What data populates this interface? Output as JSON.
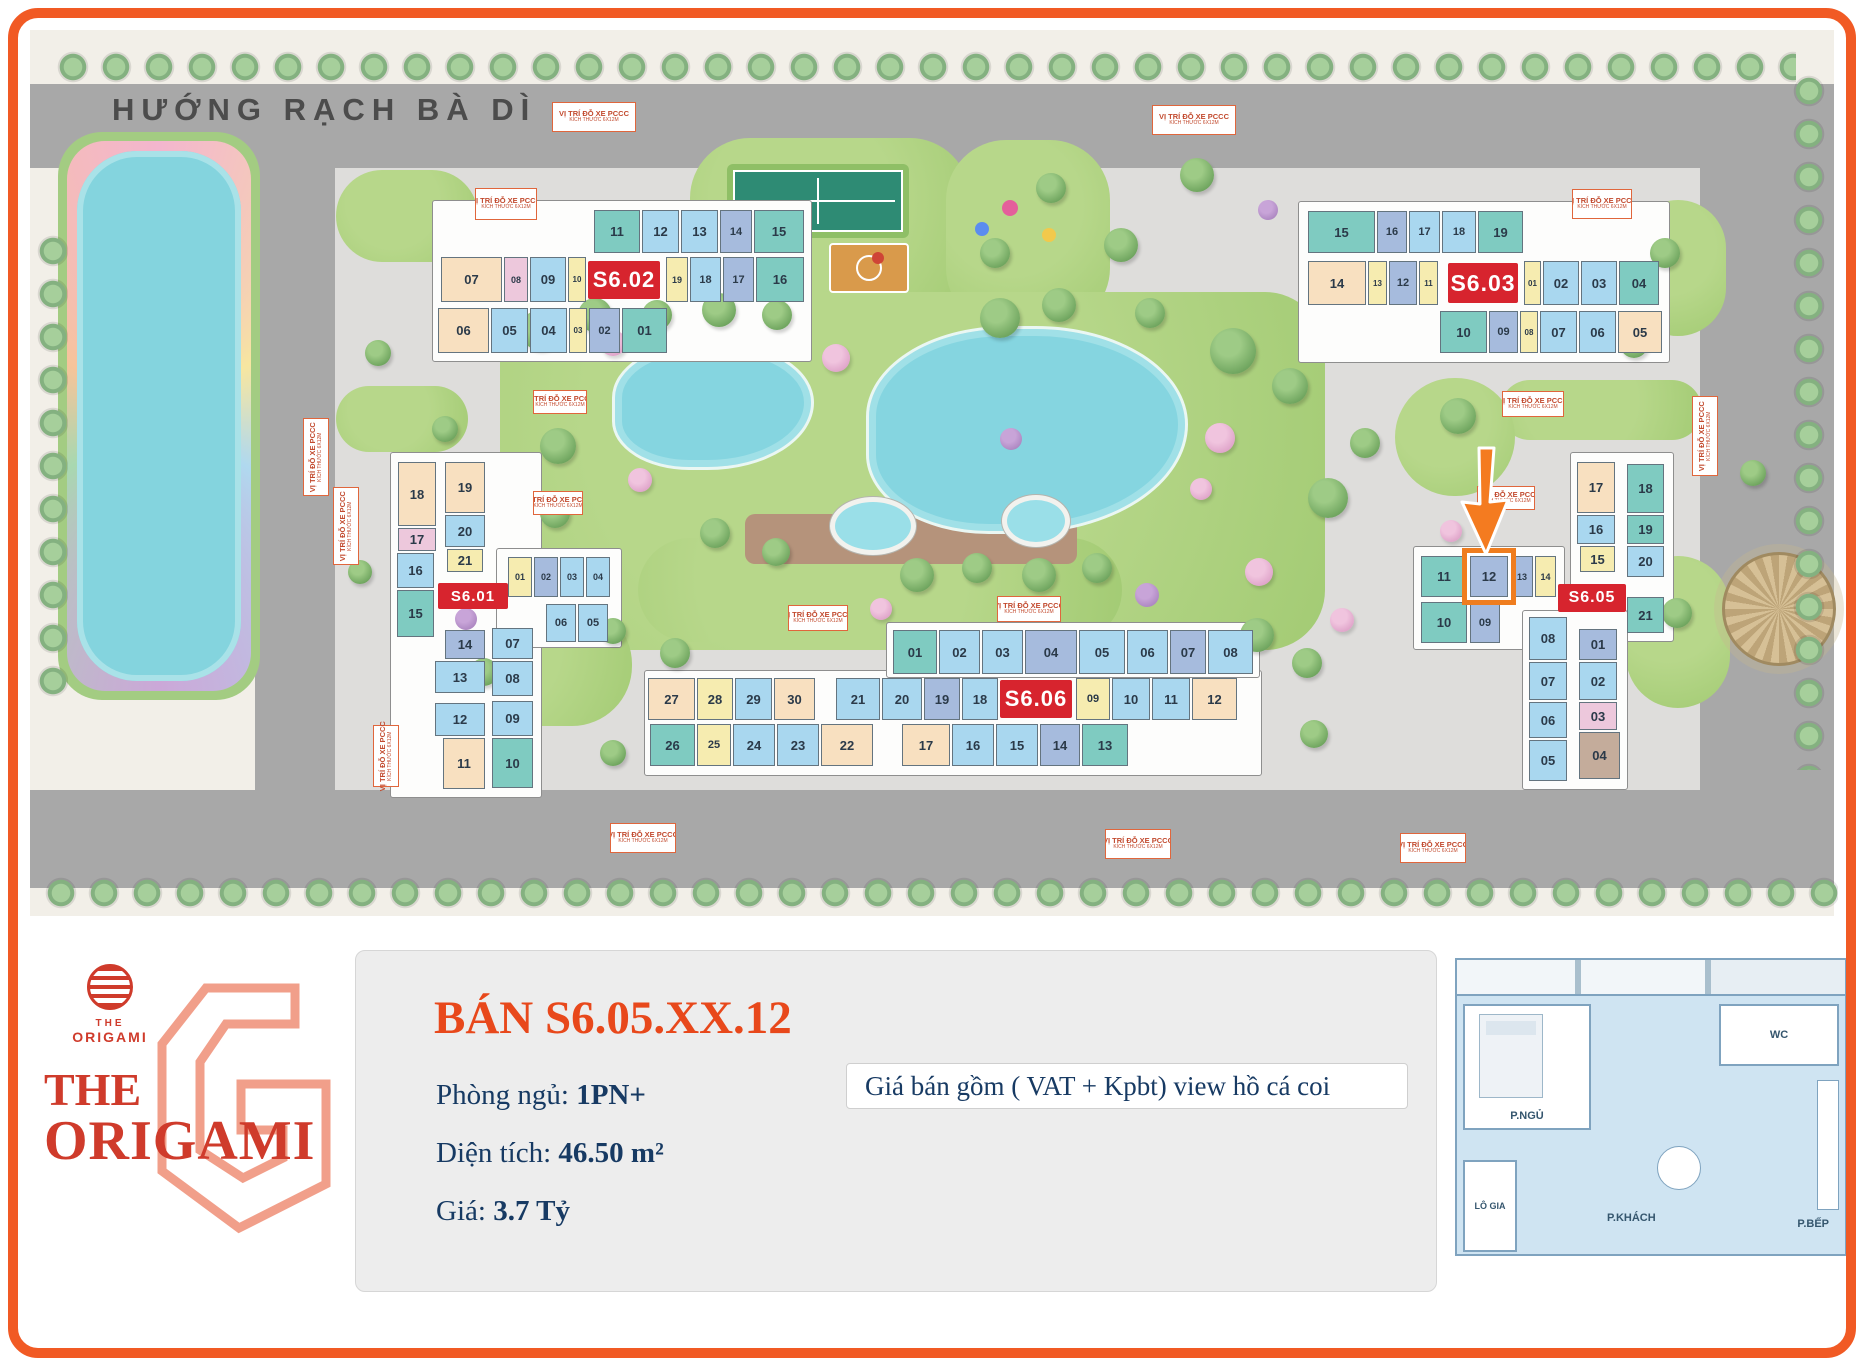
{
  "frame_color": "#F15A24",
  "map": {
    "road_label": "HƯỚNG RẠCH BÀ DÌ",
    "pccc_marker": {
      "line1": "VỊ TRÍ ĐỖ XE PCCC",
      "line2": "KÍCH THƯỚC 6X12M"
    },
    "label_color": "#D7242E",
    "highlight": {
      "building": "S6.05",
      "unit": "12",
      "color": "#EF7D1F"
    },
    "unit_colors": {
      "teal": "#7FCBC1",
      "blue": "#A9D7EF",
      "peri": "#A6BBDD",
      "yellow": "#F6ECB0",
      "cream": "#F8E0C0",
      "pink": "#EDC8DC",
      "tan": "#C4AC9B"
    },
    "marker_positions": [
      [
        475,
        188,
        62,
        32,
        0
      ],
      [
        552,
        102,
        84,
        30,
        0
      ],
      [
        1152,
        105,
        84,
        30,
        0
      ],
      [
        1572,
        189,
        60,
        30,
        0
      ],
      [
        533,
        390,
        54,
        24,
        0
      ],
      [
        533,
        491,
        50,
        24,
        0
      ],
      [
        1502,
        391,
        62,
        26,
        0
      ],
      [
        1477,
        486,
        58,
        24,
        0
      ],
      [
        788,
        605,
        60,
        26,
        0
      ],
      [
        997,
        596,
        64,
        26,
        0
      ],
      [
        610,
        823,
        66,
        30,
        0
      ],
      [
        1105,
        829,
        66,
        30,
        0
      ],
      [
        1400,
        833,
        66,
        30,
        0
      ],
      [
        333,
        487,
        26,
        78,
        1
      ],
      [
        373,
        725,
        26,
        62,
        1
      ],
      [
        1692,
        396,
        26,
        80,
        1
      ],
      [
        303,
        418,
        26,
        78,
        1
      ]
    ],
    "buildings": [
      {
        "id": "S6.01",
        "label": {
          "t": "S6.01",
          "x": 438,
          "y": 583,
          "w": 70,
          "h": 26
        },
        "units": [
          [
            "18",
            398,
            462,
            38,
            64,
            "cream"
          ],
          [
            "17",
            398,
            528,
            38,
            23,
            "pink"
          ],
          [
            "16",
            397,
            553,
            37,
            35,
            "blue"
          ],
          [
            "15",
            397,
            590,
            37,
            47,
            "teal"
          ],
          [
            "19",
            445,
            462,
            40,
            51,
            "cream"
          ],
          [
            "20",
            445,
            515,
            40,
            32,
            "blue"
          ],
          [
            "21",
            447,
            549,
            36,
            23,
            "yellow"
          ],
          [
            "01",
            508,
            557,
            24,
            40,
            "yellow"
          ],
          [
            "02",
            534,
            557,
            24,
            40,
            "peri"
          ],
          [
            "03",
            560,
            557,
            24,
            40,
            "blue"
          ],
          [
            "04",
            586,
            557,
            24,
            40,
            "blue"
          ],
          [
            "06",
            546,
            604,
            30,
            38,
            "blue"
          ],
          [
            "05",
            578,
            604,
            30,
            38,
            "blue"
          ],
          [
            "14",
            445,
            630,
            40,
            29,
            "peri"
          ],
          [
            "13",
            435,
            661,
            50,
            32,
            "blue"
          ],
          [
            "12",
            435,
            703,
            50,
            33,
            "blue"
          ],
          [
            "11",
            443,
            738,
            42,
            51,
            "cream"
          ],
          [
            "07",
            492,
            628,
            41,
            31,
            "blue"
          ],
          [
            "08",
            492,
            661,
            41,
            35,
            "blue"
          ],
          [
            "09",
            492,
            701,
            41,
            35,
            "blue"
          ],
          [
            "10",
            492,
            738,
            41,
            50,
            "teal"
          ]
        ]
      },
      {
        "id": "S6.02",
        "label": {
          "t": "S6.02",
          "x": 588,
          "y": 261,
          "w": 72,
          "h": 38
        },
        "units": [
          [
            "11",
            594,
            210,
            46,
            43,
            "teal"
          ],
          [
            "12",
            642,
            210,
            37,
            43,
            "blue"
          ],
          [
            "13",
            681,
            210,
            37,
            43,
            "blue"
          ],
          [
            "14",
            720,
            210,
            32,
            43,
            "peri"
          ],
          [
            "15",
            754,
            210,
            50,
            43,
            "teal"
          ],
          [
            "07",
            441,
            257,
            61,
            45,
            "cream"
          ],
          [
            "08",
            504,
            257,
            24,
            45,
            "pink"
          ],
          [
            "09",
            530,
            257,
            36,
            45,
            "blue"
          ],
          [
            "10",
            568,
            257,
            18,
            45,
            "yellow"
          ],
          [
            "19",
            666,
            257,
            22,
            45,
            "yellow"
          ],
          [
            "18",
            690,
            257,
            31,
            45,
            "blue"
          ],
          [
            "17",
            723,
            257,
            31,
            45,
            "peri"
          ],
          [
            "16",
            756,
            257,
            48,
            45,
            "teal"
          ],
          [
            "06",
            438,
            308,
            51,
            45,
            "cream"
          ],
          [
            "05",
            491,
            308,
            37,
            45,
            "blue"
          ],
          [
            "04",
            530,
            308,
            37,
            45,
            "blue"
          ],
          [
            "03",
            569,
            308,
            18,
            45,
            "yellow"
          ],
          [
            "02",
            589,
            308,
            31,
            45,
            "peri"
          ],
          [
            "01",
            622,
            308,
            45,
            45,
            "teal"
          ]
        ]
      },
      {
        "id": "S6.03",
        "label": {
          "t": "S6.03",
          "x": 1448,
          "y": 263,
          "w": 70,
          "h": 40
        },
        "units": [
          [
            "15",
            1308,
            211,
            67,
            42,
            "teal"
          ],
          [
            "16",
            1377,
            211,
            30,
            42,
            "peri"
          ],
          [
            "17",
            1409,
            211,
            31,
            42,
            "blue"
          ],
          [
            "18",
            1442,
            211,
            34,
            42,
            "blue"
          ],
          [
            "19",
            1478,
            211,
            45,
            42,
            "teal"
          ],
          [
            "14",
            1308,
            261,
            58,
            44,
            "cream"
          ],
          [
            "13",
            1368,
            261,
            19,
            44,
            "yellow"
          ],
          [
            "12",
            1389,
            261,
            28,
            44,
            "peri"
          ],
          [
            "11",
            1419,
            261,
            19,
            44,
            "yellow"
          ],
          [
            "01",
            1524,
            261,
            17,
            44,
            "yellow"
          ],
          [
            "02",
            1543,
            261,
            36,
            44,
            "blue"
          ],
          [
            "03",
            1581,
            261,
            36,
            44,
            "blue"
          ],
          [
            "04",
            1619,
            261,
            40,
            44,
            "teal"
          ],
          [
            "10",
            1440,
            311,
            47,
            42,
            "teal"
          ],
          [
            "09",
            1489,
            311,
            29,
            42,
            "peri"
          ],
          [
            "08",
            1520,
            311,
            18,
            42,
            "yellow"
          ],
          [
            "07",
            1540,
            311,
            37,
            42,
            "blue"
          ],
          [
            "06",
            1579,
            311,
            37,
            42,
            "blue"
          ],
          [
            "05",
            1618,
            311,
            44,
            42,
            "cream"
          ]
        ]
      },
      {
        "id": "S6.05",
        "label": {
          "t": "S6.05",
          "x": 1558,
          "y": 584,
          "w": 68,
          "h": 28
        },
        "units": [
          [
            "17",
            1577,
            462,
            38,
            51,
            "cream"
          ],
          [
            "18",
            1627,
            464,
            37,
            49,
            "teal"
          ],
          [
            "16",
            1577,
            515,
            38,
            29,
            "blue"
          ],
          [
            "19",
            1627,
            515,
            37,
            29,
            "teal"
          ],
          [
            "15",
            1580,
            546,
            35,
            26,
            "yellow"
          ],
          [
            "20",
            1627,
            546,
            37,
            31,
            "blue"
          ],
          [
            "21",
            1627,
            597,
            37,
            36,
            "teal"
          ],
          [
            "11",
            1421,
            556,
            46,
            41,
            "teal"
          ],
          [
            "12",
            1470,
            556,
            38,
            41,
            "peri",
            1
          ],
          [
            "13",
            1511,
            556,
            22,
            41,
            "peri"
          ],
          [
            "14",
            1535,
            556,
            21,
            41,
            "yellow"
          ],
          [
            "10",
            1421,
            602,
            46,
            41,
            "teal"
          ],
          [
            "09",
            1470,
            602,
            30,
            41,
            "peri"
          ],
          [
            "08",
            1529,
            617,
            38,
            43,
            "blue"
          ],
          [
            "07",
            1529,
            662,
            38,
            38,
            "blue"
          ],
          [
            "06",
            1529,
            702,
            38,
            36,
            "blue"
          ],
          [
            "05",
            1529,
            740,
            38,
            41,
            "blue"
          ],
          [
            "01",
            1579,
            629,
            38,
            31,
            "peri"
          ],
          [
            "02",
            1579,
            662,
            38,
            38,
            "blue"
          ],
          [
            "03",
            1579,
            702,
            38,
            28,
            "pink"
          ],
          [
            "04",
            1579,
            732,
            41,
            47,
            "tan"
          ]
        ]
      },
      {
        "id": "S6.06",
        "label": {
          "t": "S6.06",
          "x": 1000,
          "y": 680,
          "w": 72,
          "h": 38
        },
        "units": [
          [
            "01",
            893,
            630,
            44,
            44,
            "teal"
          ],
          [
            "02",
            939,
            630,
            41,
            44,
            "blue"
          ],
          [
            "03",
            982,
            630,
            41,
            44,
            "blue"
          ],
          [
            "04",
            1025,
            630,
            52,
            44,
            "peri"
          ],
          [
            "05",
            1079,
            630,
            46,
            44,
            "blue"
          ],
          [
            "06",
            1127,
            630,
            41,
            44,
            "blue"
          ],
          [
            "07",
            1170,
            630,
            36,
            44,
            "peri"
          ],
          [
            "08",
            1208,
            630,
            45,
            44,
            "blue"
          ],
          [
            "27",
            648,
            678,
            47,
            42,
            "cream"
          ],
          [
            "28",
            697,
            678,
            36,
            42,
            "yellow"
          ],
          [
            "29",
            735,
            678,
            37,
            42,
            "blue"
          ],
          [
            "30",
            774,
            678,
            41,
            42,
            "cream"
          ],
          [
            "21",
            836,
            678,
            44,
            42,
            "blue"
          ],
          [
            "20",
            882,
            678,
            40,
            42,
            "blue"
          ],
          [
            "19",
            924,
            678,
            36,
            42,
            "peri"
          ],
          [
            "18",
            962,
            678,
            36,
            42,
            "blue"
          ],
          [
            "09",
            1076,
            678,
            34,
            42,
            "yellow"
          ],
          [
            "10",
            1112,
            678,
            38,
            42,
            "blue"
          ],
          [
            "11",
            1152,
            678,
            38,
            42,
            "blue"
          ],
          [
            "12",
            1192,
            678,
            45,
            42,
            "cream"
          ],
          [
            "26",
            650,
            724,
            45,
            42,
            "teal"
          ],
          [
            "25",
            697,
            724,
            34,
            42,
            "yellow"
          ],
          [
            "24",
            733,
            724,
            42,
            42,
            "blue"
          ],
          [
            "23",
            777,
            724,
            42,
            42,
            "blue"
          ],
          [
            "22",
            821,
            724,
            52,
            42,
            "cream"
          ],
          [
            "17",
            902,
            724,
            48,
            42,
            "cream"
          ],
          [
            "16",
            952,
            724,
            42,
            42,
            "blue"
          ],
          [
            "15",
            996,
            724,
            42,
            42,
            "blue"
          ],
          [
            "14",
            1040,
            724,
            40,
            42,
            "peri"
          ],
          [
            "13",
            1082,
            724,
            46,
            42,
            "teal"
          ]
        ]
      }
    ]
  },
  "panel": {
    "logo": {
      "small_top": "THE",
      "small_bottom": "ORIGAMI",
      "big_top": "THE",
      "big_bottom": "ORIGAMI"
    },
    "listing": {
      "title": "BÁN S6.05.XX.12",
      "fields": [
        {
          "label": "Phòng ngủ: ",
          "value": "1PN+"
        },
        {
          "label": "Diện tích: ",
          "value": "46.50 m²"
        },
        {
          "label": "Giá: ",
          "value": "3.7 Tỷ"
        }
      ],
      "note": "Giá bán gồm ( VAT + Kpbt) view hồ cá coi"
    },
    "floorplan": {
      "wc": "WC",
      "bedroom": "P.NGỦ",
      "balcony": "LÔ GIA",
      "living": "P.KHÁCH",
      "kitchen": "P.BẾP"
    }
  }
}
